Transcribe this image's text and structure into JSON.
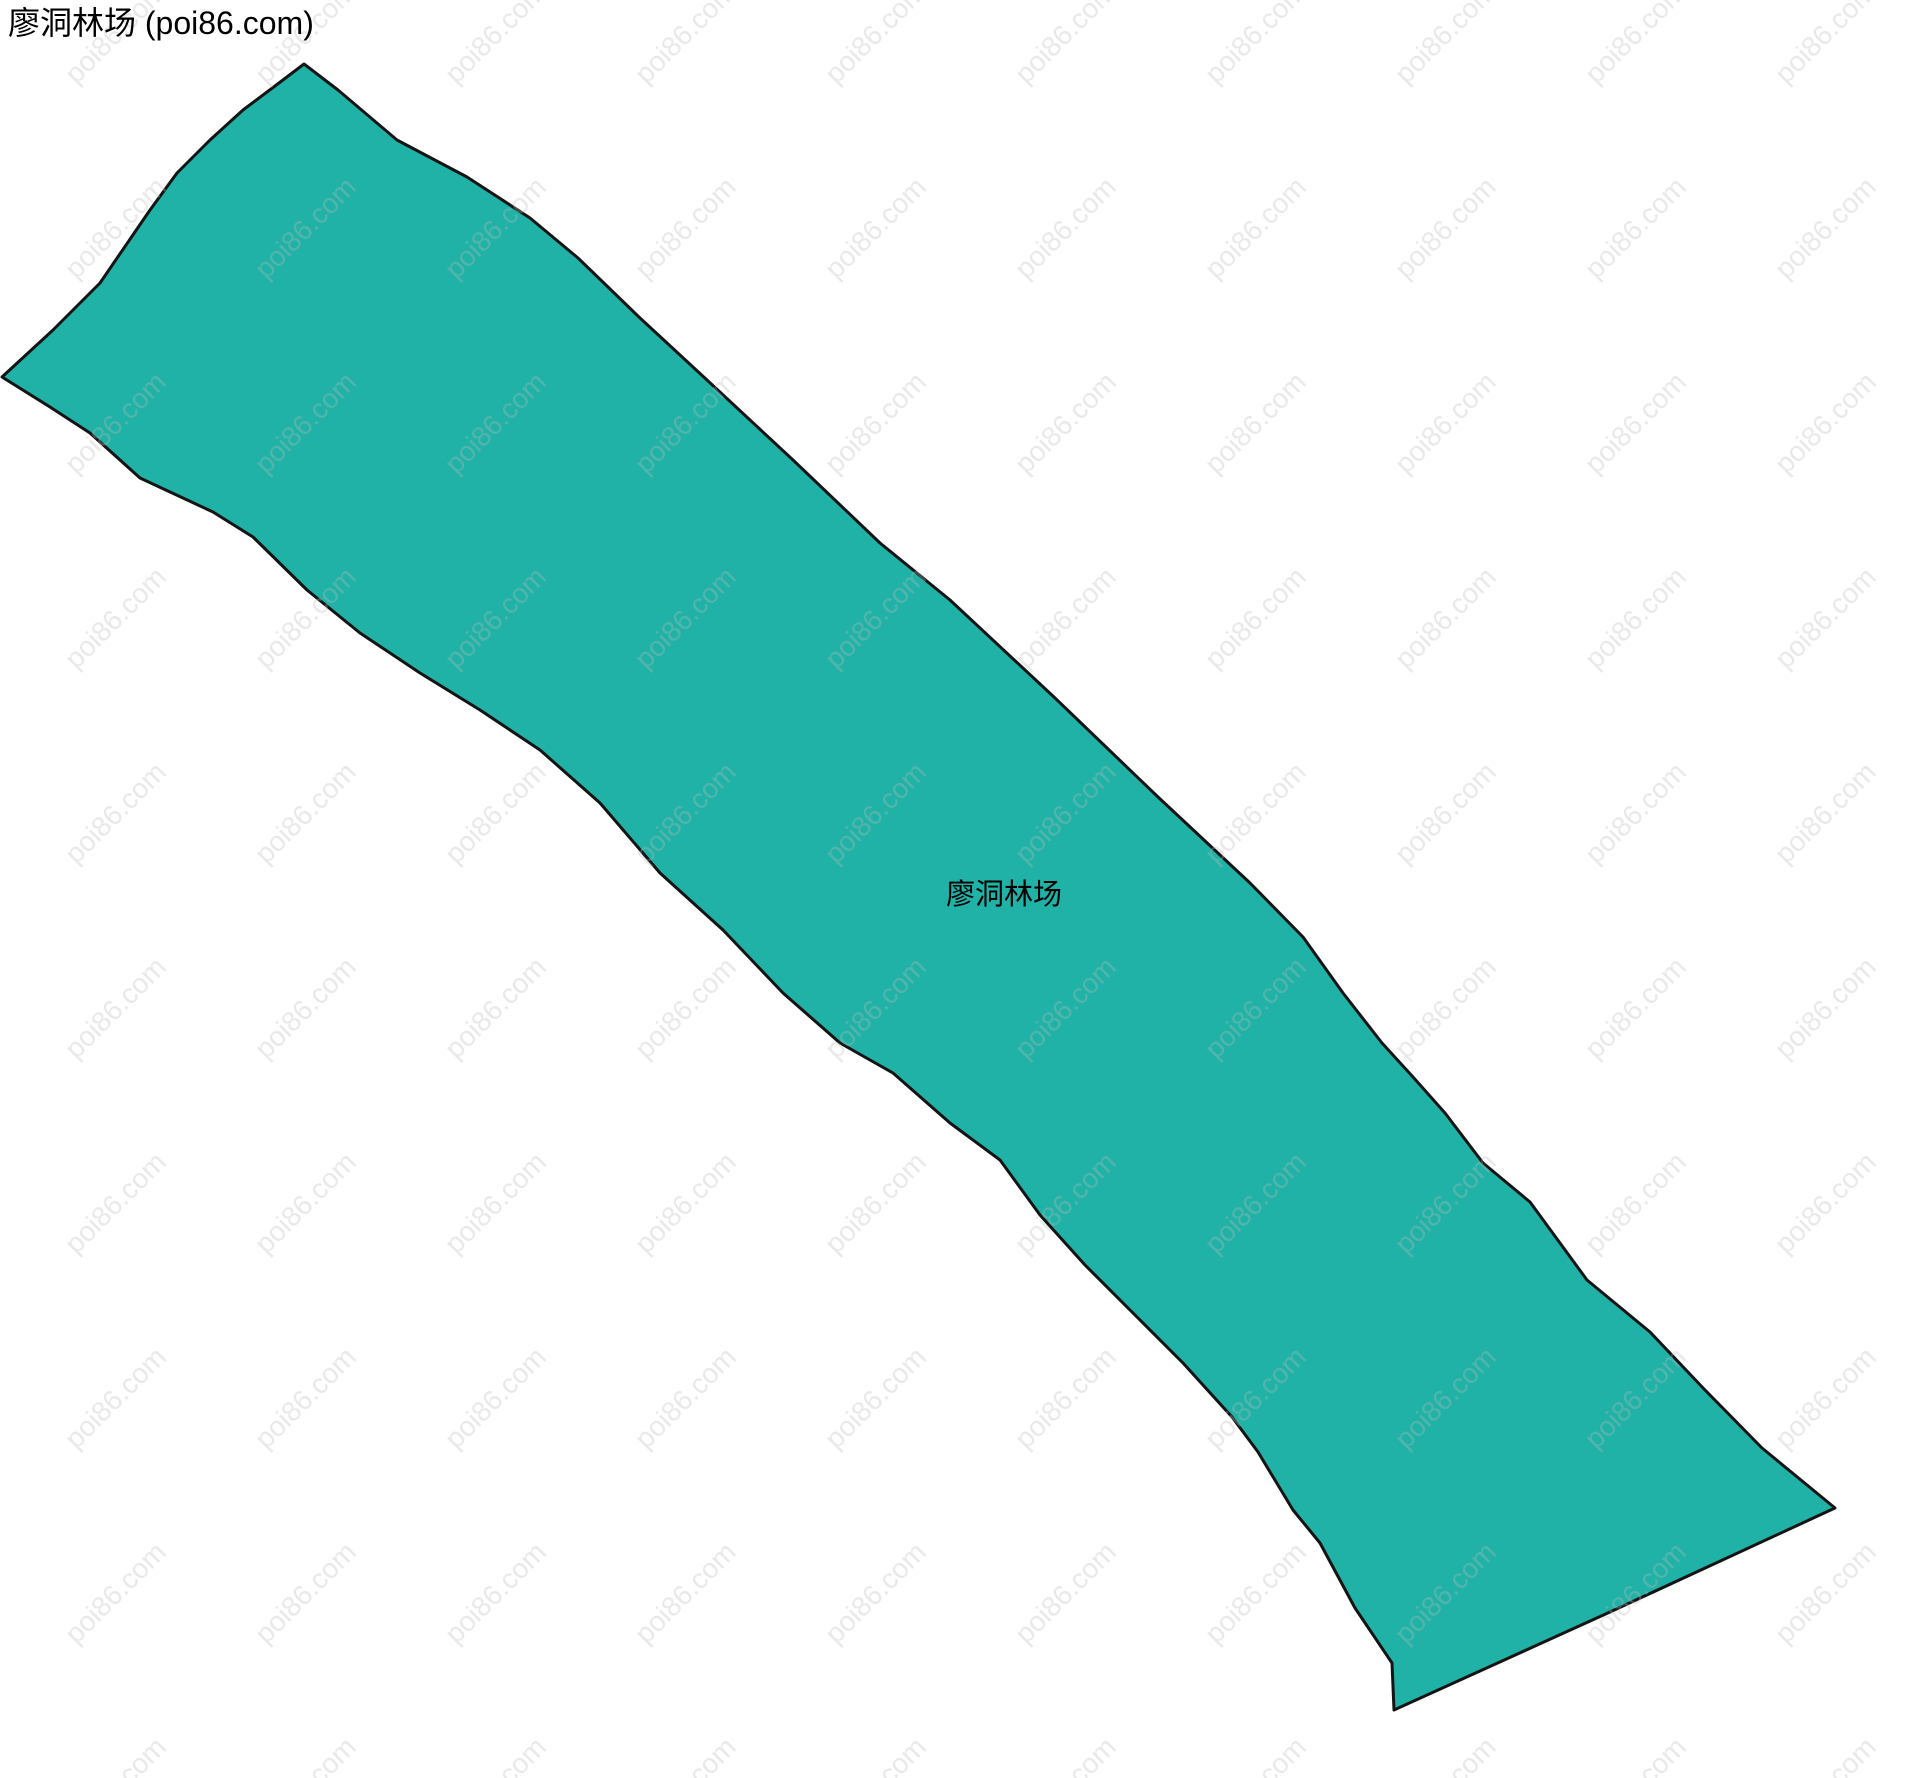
{
  "page": {
    "title": "廖洞林场 (poi86.com)",
    "background_color": "#ffffff"
  },
  "map": {
    "region_label": "廖洞林场",
    "fill_color": "#20b2a6",
    "stroke_color": "#141414",
    "stroke_width": 3,
    "outline_points": [
      [
        304,
        64
      ],
      [
        338,
        90
      ],
      [
        397,
        140
      ],
      [
        467,
        177
      ],
      [
        530,
        218
      ],
      [
        578,
        258
      ],
      [
        640,
        318
      ],
      [
        707,
        380
      ],
      [
        793,
        460
      ],
      [
        880,
        543
      ],
      [
        950,
        600
      ],
      [
        1055,
        698
      ],
      [
        1158,
        797
      ],
      [
        1250,
        883
      ],
      [
        1303,
        937
      ],
      [
        1343,
        993
      ],
      [
        1382,
        1043
      ],
      [
        1413,
        1077
      ],
      [
        1445,
        1113
      ],
      [
        1483,
        1163
      ],
      [
        1530,
        1202
      ],
      [
        1587,
        1280
      ],
      [
        1650,
        1332
      ],
      [
        1705,
        1390
      ],
      [
        1762,
        1448
      ],
      [
        1835,
        1508
      ],
      [
        1610,
        1612
      ],
      [
        1394,
        1710
      ],
      [
        1392,
        1663
      ],
      [
        1355,
        1608
      ],
      [
        1320,
        1543
      ],
      [
        1293,
        1510
      ],
      [
        1258,
        1452
      ],
      [
        1232,
        1417
      ],
      [
        1183,
        1363
      ],
      [
        1137,
        1317
      ],
      [
        1085,
        1265
      ],
      [
        1040,
        1215
      ],
      [
        1000,
        1160
      ],
      [
        950,
        1123
      ],
      [
        893,
        1073
      ],
      [
        840,
        1043
      ],
      [
        783,
        993
      ],
      [
        723,
        930
      ],
      [
        660,
        873
      ],
      [
        600,
        803
      ],
      [
        540,
        750
      ],
      [
        480,
        710
      ],
      [
        420,
        673
      ],
      [
        360,
        633
      ],
      [
        307,
        590
      ],
      [
        253,
        537
      ],
      [
        213,
        512
      ],
      [
        140,
        478
      ],
      [
        90,
        433
      ],
      [
        50,
        407
      ],
      [
        2,
        377
      ],
      [
        53,
        330
      ],
      [
        100,
        283
      ],
      [
        150,
        210
      ],
      [
        177,
        173
      ],
      [
        210,
        140
      ],
      [
        243,
        110
      ],
      [
        275,
        86
      ]
    ]
  },
  "watermark": {
    "text": "poi86.com",
    "fill_color": "#bcbcbc",
    "fill_opacity": 0.32,
    "font_size": 28,
    "rotation_deg": -45,
    "tile_width": 190,
    "tile_height": 195,
    "offset_x": 20,
    "offset_y": 130
  }
}
